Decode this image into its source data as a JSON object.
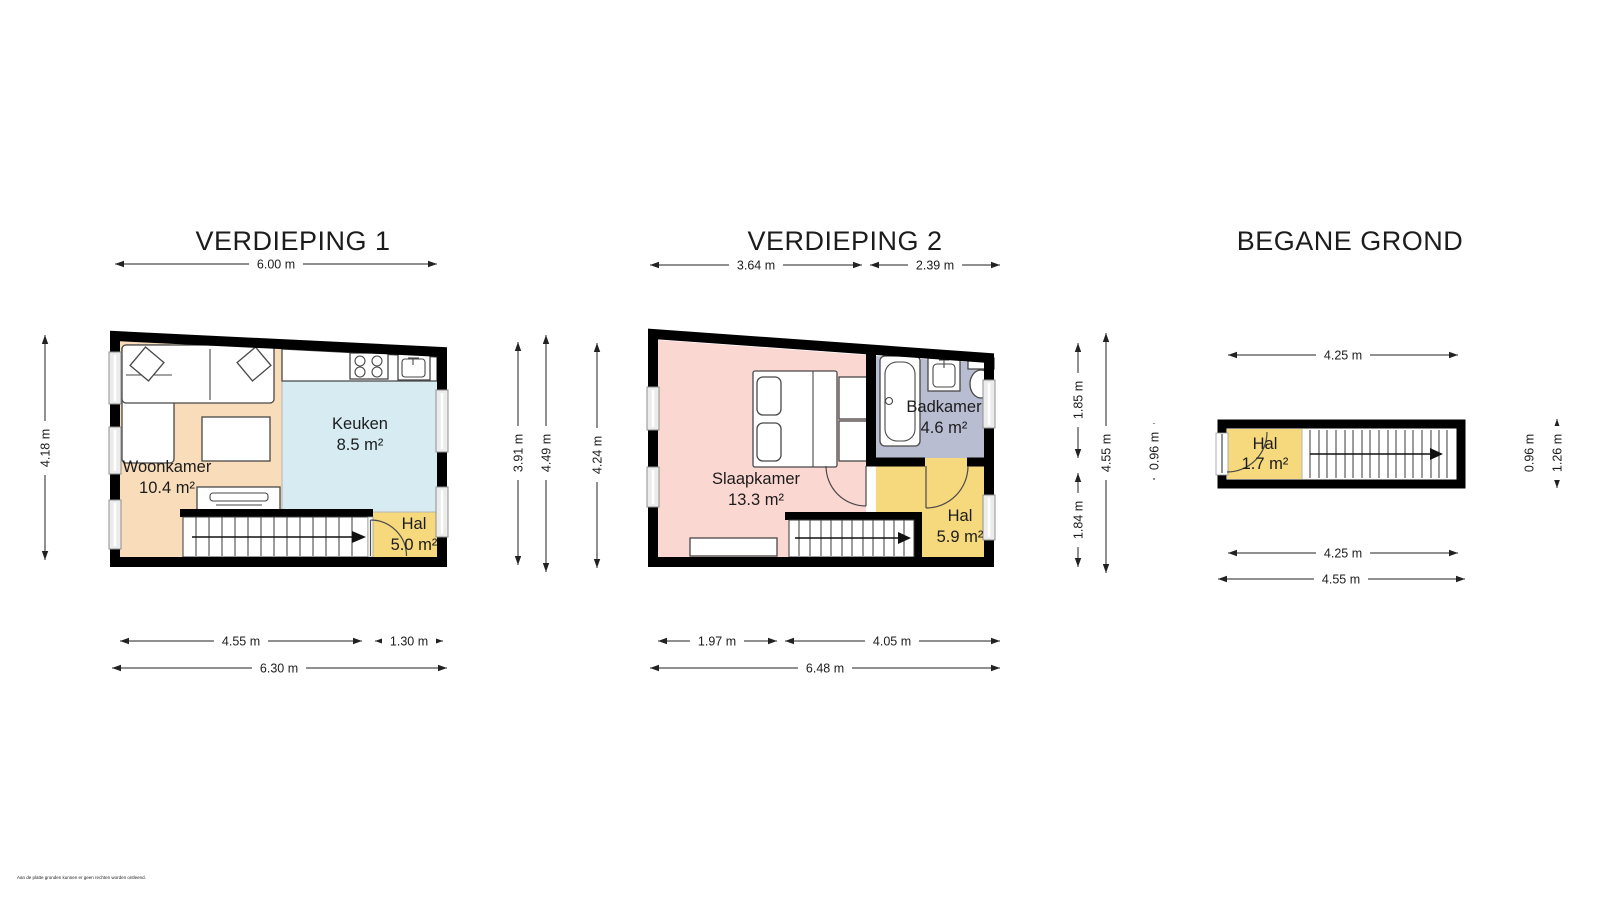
{
  "disclaimer": "Aan de platte gronden kunnen er geen rechten worden ontleend.",
  "colors": {
    "wall": "#000000",
    "woonkamer": "#f9ddba",
    "keuken": "#d6ecf2",
    "hal": "#f6d97c",
    "slaapkamer": "#fbd7d2",
    "badkamer": "#b9bdd2"
  },
  "plans": [
    {
      "title": "VERDIEPING 1",
      "rooms": {
        "woonkamer": {
          "name": "Woonkamer",
          "area": "10.4 m²"
        },
        "keuken": {
          "name": "Keuken",
          "area": "8.5 m²"
        },
        "hal": {
          "name": "Hal",
          "area": "5.0 m²"
        }
      },
      "dims": {
        "top": "6.00 m",
        "left": "4.18 m",
        "right_inner": "3.91 m",
        "right_outer": "4.49 m",
        "bottom_left": "4.55 m",
        "bottom_right": "1.30 m",
        "bottom_total": "6.30 m"
      }
    },
    {
      "title": "VERDIEPING 2",
      "rooms": {
        "slaapkamer": {
          "name": "Slaapkamer",
          "area": "13.3 m²"
        },
        "badkamer": {
          "name": "Badkamer",
          "area": "4.6 m²"
        },
        "hal": {
          "name": "Hal",
          "area": "5.9 m²"
        }
      },
      "dims": {
        "top_left": "3.64 m",
        "top_right": "2.39 m",
        "left": "4.24 m",
        "right_top": "1.85 m",
        "right_bottom": "1.84 m",
        "right_total": "4.55 m",
        "bottom_left": "1.97 m",
        "bottom_right": "4.05 m",
        "bottom_total": "6.48 m"
      }
    },
    {
      "title": "BEGANE GROND",
      "rooms": {
        "hal": {
          "name": "Hal",
          "area": "1.7 m²"
        }
      },
      "dims": {
        "top": "4.25 m",
        "left": "0.96 m",
        "right_inner": "0.96 m",
        "right_outer": "1.26 m",
        "bottom_inner": "4.25 m",
        "bottom_total": "4.55 m"
      }
    }
  ]
}
